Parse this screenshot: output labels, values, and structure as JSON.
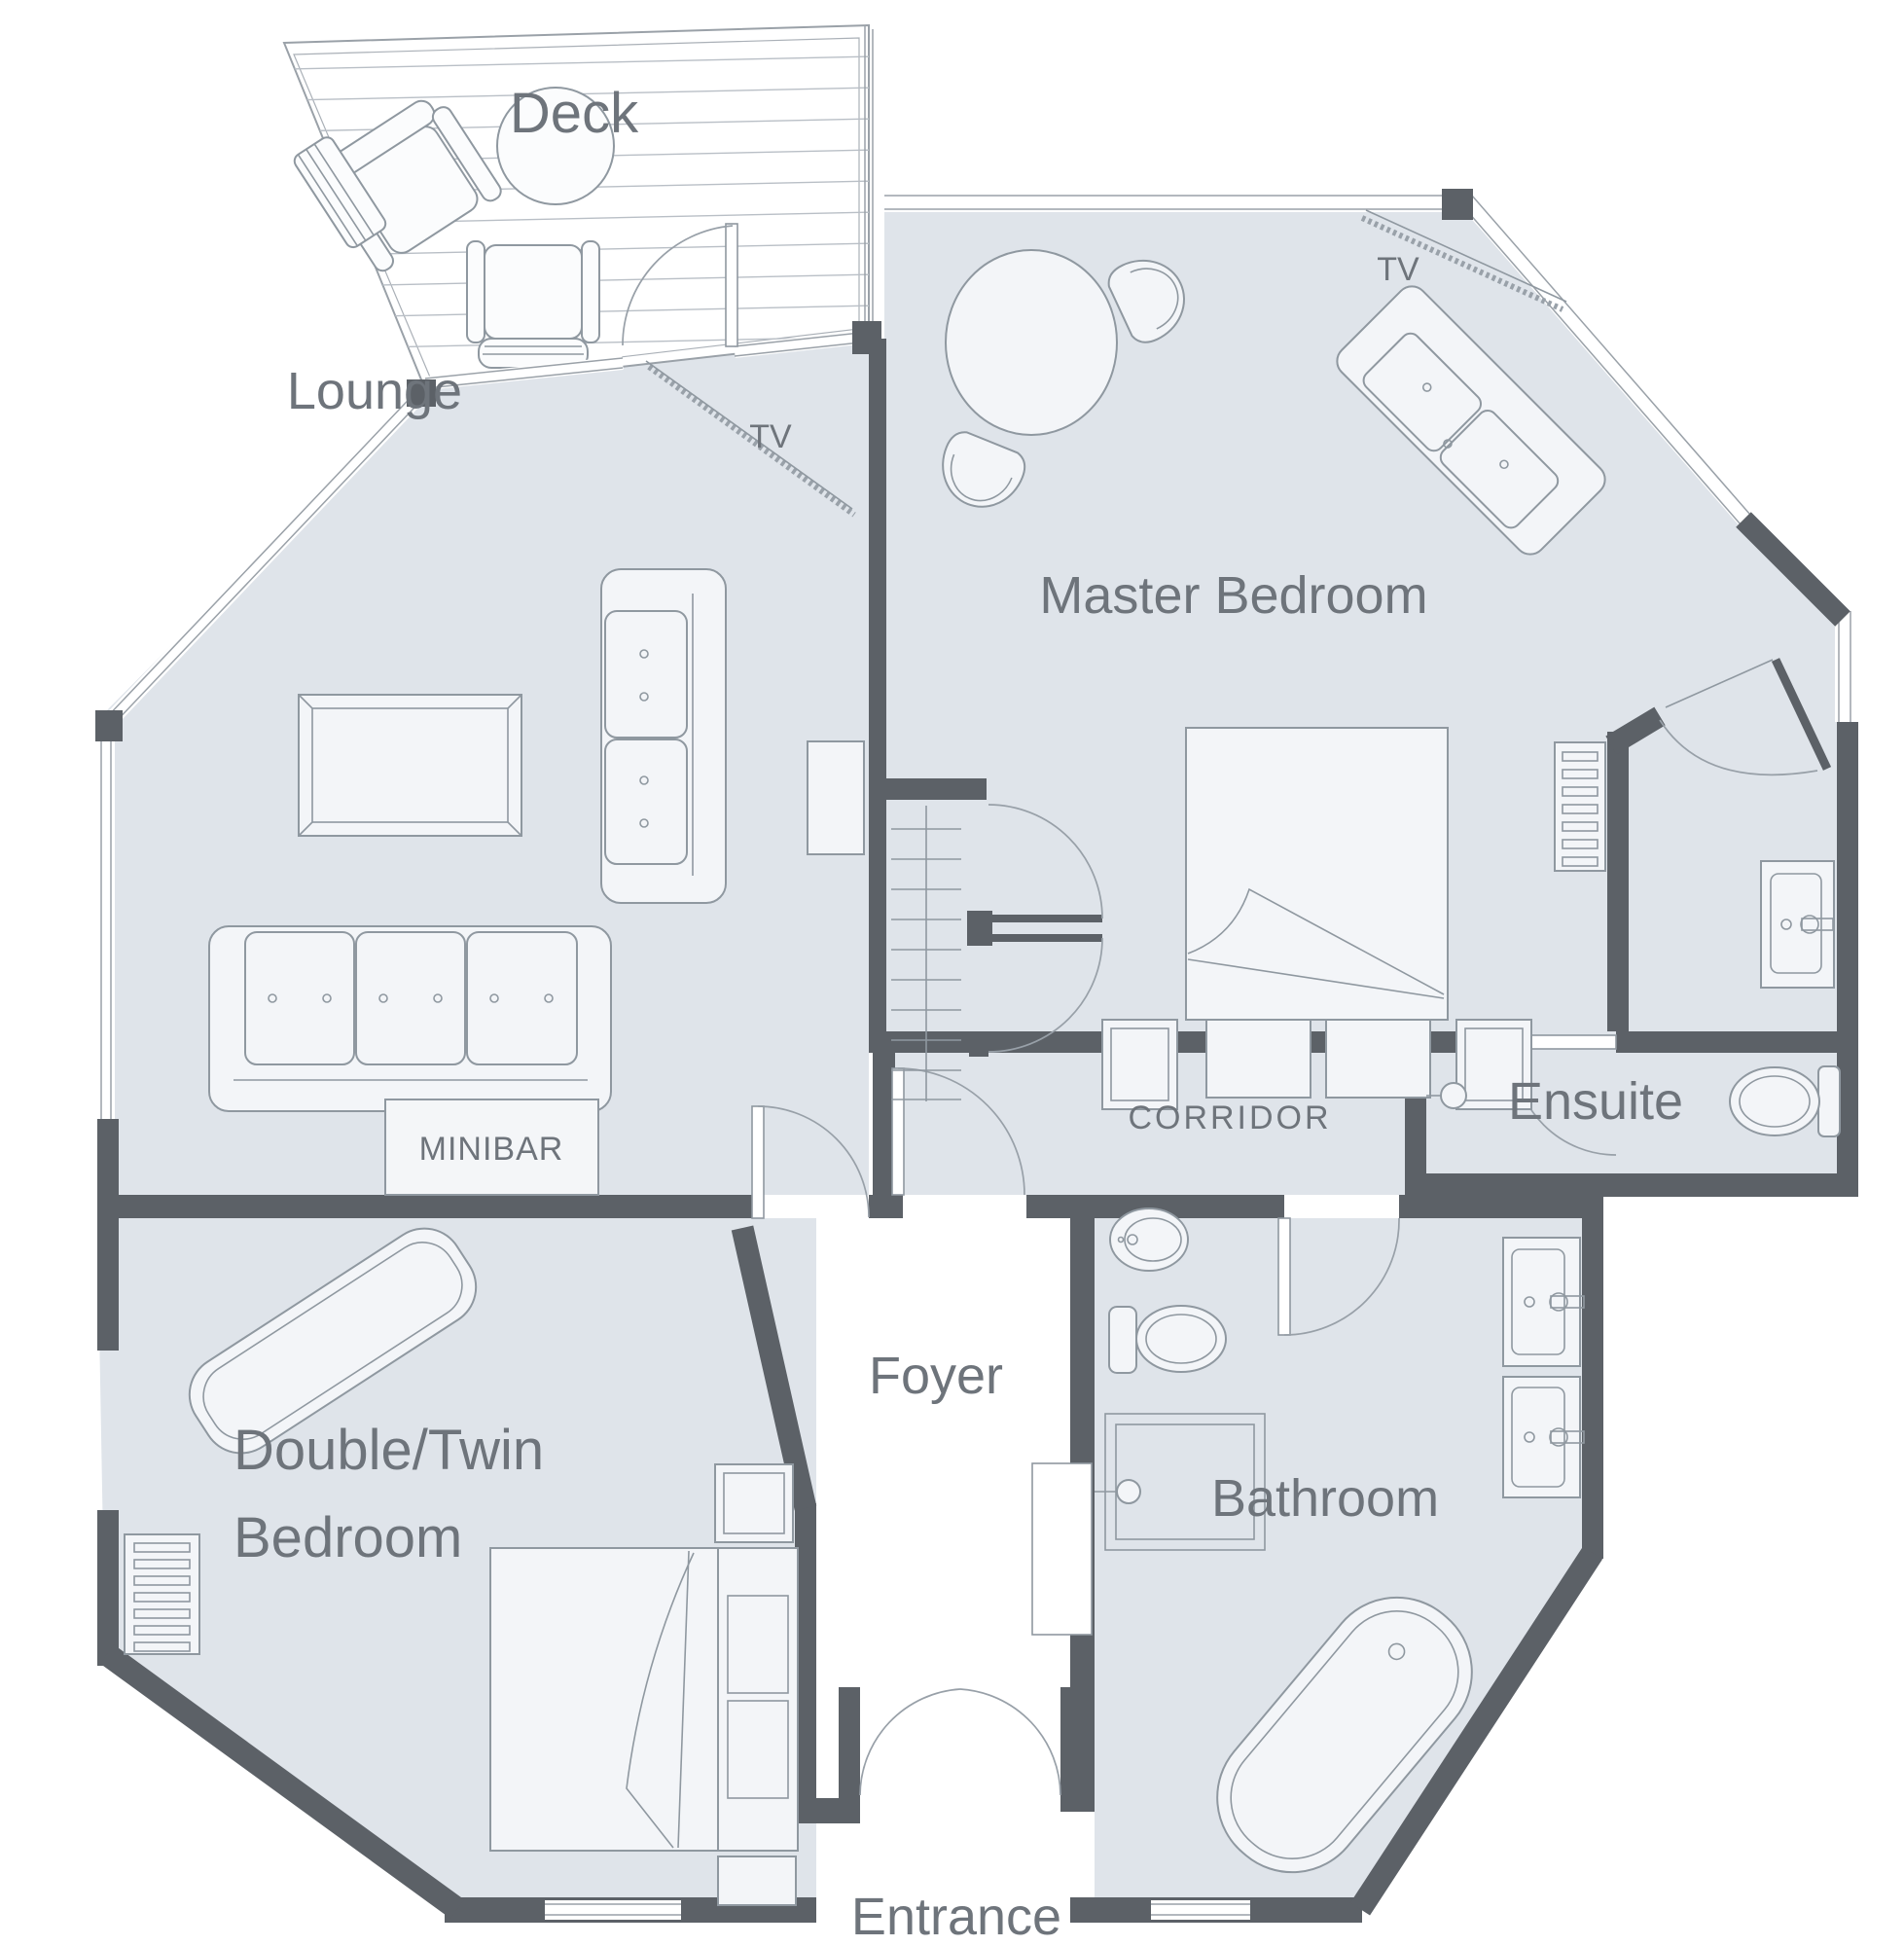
{
  "title": "Suite floor plan",
  "colors": {
    "background": "#ffffff",
    "room_fill": "#dfe4ea",
    "wall": "#5c6167",
    "furniture_fill": "#f3f5f8",
    "furniture_stroke": "#8f98a0",
    "label_text": "#6e747b"
  },
  "rooms": {
    "deck": {
      "label": "Deck"
    },
    "lounge": {
      "label": "Lounge",
      "tv_label": "TV",
      "minibar_label": "MINIBAR"
    },
    "master_bedroom": {
      "label": "Master Bedroom",
      "tv_label": "TV"
    },
    "ensuite": {
      "label": "Ensuite"
    },
    "corridor": {
      "label": "CORRIDOR"
    },
    "foyer": {
      "label": "Foyer"
    },
    "double_twin_bedroom": {
      "label_line1": "Double/Twin",
      "label_line2": "Bedroom"
    },
    "bathroom": {
      "label": "Bathroom"
    },
    "entrance": {
      "label": "Entrance"
    }
  }
}
